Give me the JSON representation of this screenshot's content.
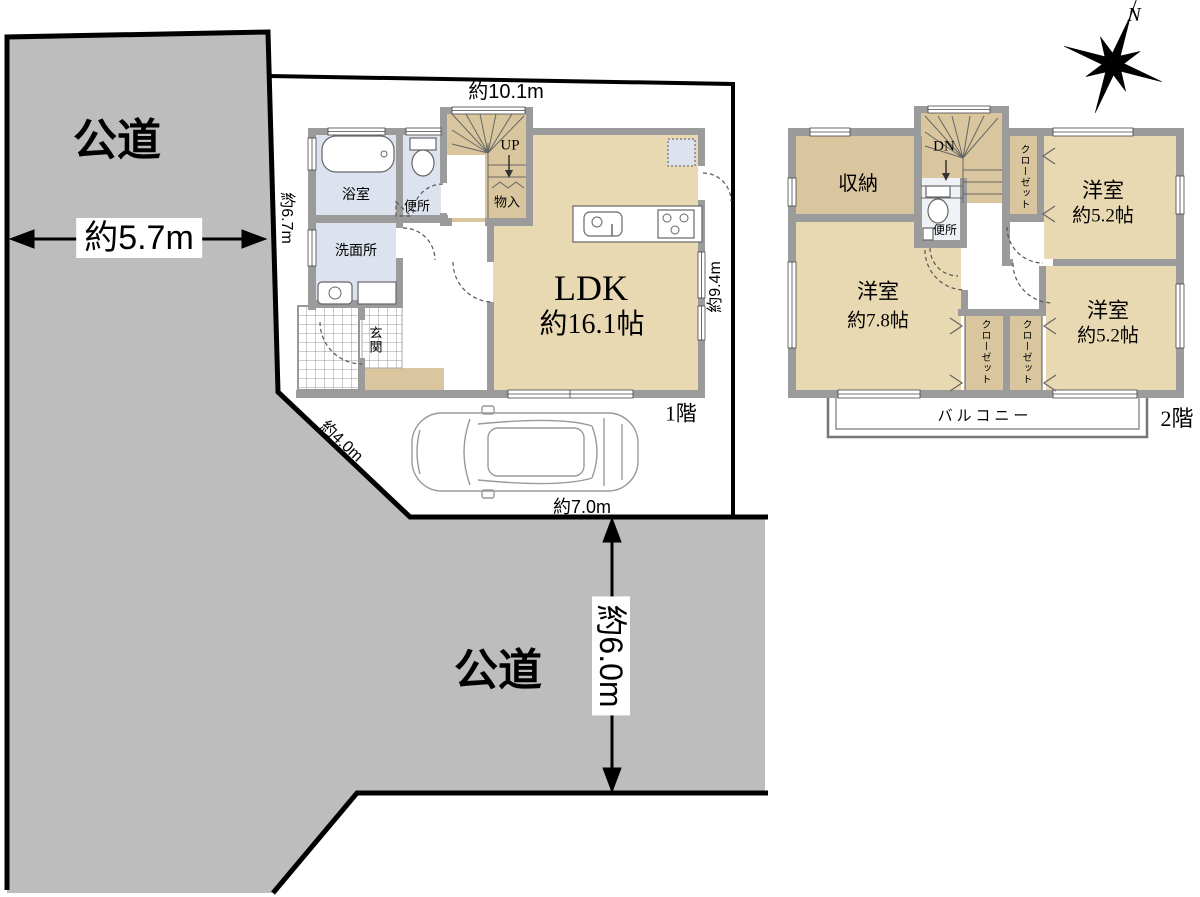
{
  "colors": {
    "road": "#bdbdbd",
    "wall": "#9b9b9b",
    "tan": "#e9d9b2",
    "tan2": "#d9c69e",
    "blue": "#dce3ee",
    "line": "#000000"
  },
  "site": {
    "road_left_label": "公道",
    "road_left_width": "約5.7m",
    "road_bottom_label": "公道",
    "road_bottom_width": "約6.0m",
    "dim_left_edge": "約6.7m",
    "dim_diagonal": "約4.0m",
    "dim_bottom_edge": "約7.0m"
  },
  "floor1": {
    "floor_label": "1階",
    "dim_top": "約10.1m",
    "dim_right": "約9.4m",
    "ldk_line1": "LDK",
    "ldk_line2": "約16.1帖",
    "bath": "浴室",
    "toilet": "便所",
    "washroom": "洗面所",
    "entrance": "玄関",
    "storage": "物入",
    "stairs_label": "UP"
  },
  "floor2": {
    "floor_label": "2階",
    "storage": "収納",
    "stairs_label": "DN",
    "toilet": "便所",
    "closet_top": "クローゼット",
    "closet_left": "クローゼット",
    "closet_right": "クローゼット",
    "bedroom_tr_name": "洋室",
    "bedroom_tr_size": "約5.2帖",
    "bedroom_l_name": "洋室",
    "bedroom_l_size": "約7.8帖",
    "bedroom_br_name": "洋室",
    "bedroom_br_size": "約5.2帖",
    "balcony": "バルコニー"
  },
  "compass": {
    "north": "N"
  }
}
